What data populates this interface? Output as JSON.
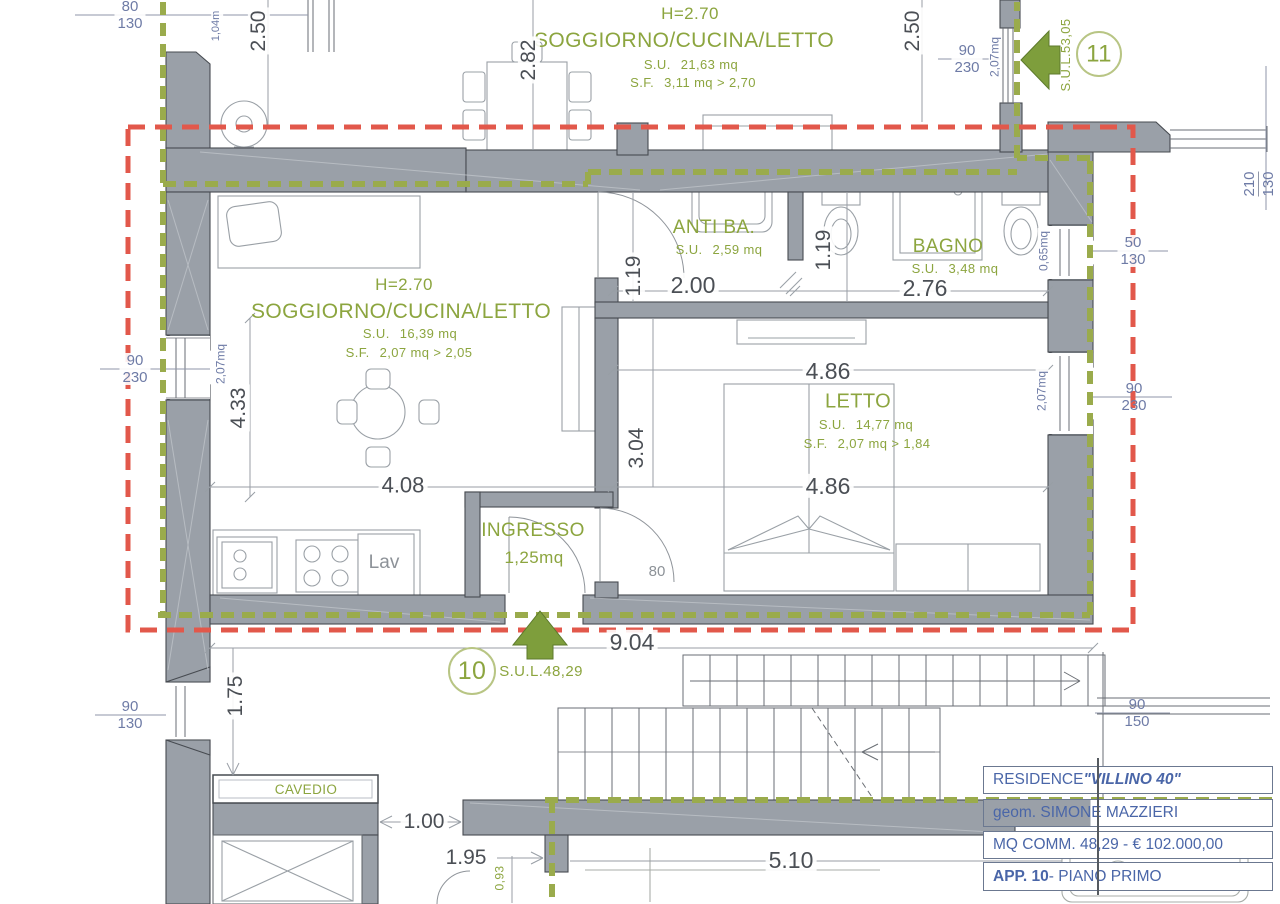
{
  "units": {
    "u10": {
      "number": "10",
      "sul": "S.U.L.48,29"
    },
    "u11": {
      "number": "11",
      "sul": "S.U.L.53,05"
    }
  },
  "rooms": {
    "upper": {
      "height": "H=2.70",
      "name": "SOGGIORNO/CUCINA/LETTO",
      "su_label": "S.U.",
      "su_value": "21,63 mq",
      "sf_label": "S.F.",
      "sf_value": "3,11 mq > 2,70"
    },
    "soggiorno": {
      "height": "H=2.70",
      "name": "SOGGIORNO/CUCINA/LETTO",
      "su_label": "S.U.",
      "su_value": "16,39 mq",
      "sf_label": "S.F.",
      "sf_value": "2,07 mq > 2,05"
    },
    "antibagno": {
      "name": "ANTI BA.",
      "su_label": "S.U.",
      "su_value": "2,59 mq"
    },
    "bagno": {
      "name": "BAGNO",
      "su_label": "S.U.",
      "su_value": "3,48 mq"
    },
    "letto": {
      "name": "LETTO",
      "su_label": "S.U.",
      "su_value": "14,77 mq",
      "sf_label": "S.F.",
      "sf_value": "2,07 mq > 1,84"
    },
    "ingresso": {
      "name": "INGRESSO",
      "area": "1,25mq"
    },
    "cavedio": {
      "name": "CAVEDIO"
    },
    "lav": {
      "name": "Lav"
    }
  },
  "dims": {
    "d80_130": {
      "top": "80",
      "bottom": "130"
    },
    "d104m": "1,04m",
    "d250_left": "2.50",
    "d282": "2.82",
    "d250_right": "2.50",
    "d90_230_top": {
      "top": "90",
      "bottom": "230"
    },
    "d207mq_top": "2,07mq",
    "d210_130": {
      "top": "210",
      "bottom": "130"
    },
    "d119_left": "1.19",
    "d200": "2.00",
    "d119_right": "1.19",
    "d276": "2.76",
    "d065mq": "0,65mq",
    "d50_130": {
      "top": "50",
      "bottom": "130"
    },
    "d90_230_left": {
      "top": "90",
      "bottom": "230"
    },
    "d207mq_left": "2,07mq",
    "d433": "4.33",
    "d90_230_right": {
      "top": "90",
      "bottom": "230"
    },
    "d207mq_right": "2,07mq",
    "d486_top": "4.86",
    "d486_bottom": "4.86",
    "d304": "3.04",
    "d408": "4.08",
    "d80_door": "80",
    "d904": "9.04",
    "d175": "1.75",
    "d90_130": {
      "top": "90",
      "bottom": "130"
    },
    "d90_150": {
      "top": "90",
      "bottom": "150"
    },
    "d100": "1.00",
    "d195": "1.95",
    "d093": "0,93",
    "d510": "5.10"
  },
  "title_block": {
    "row1_normal": "RESIDENCE ",
    "row1_bold": "\"VILLINO 40\"",
    "row2": "geom. SIMONE MAZZIERI",
    "row3": "MQ COMM. 48,29 - € 102.000,00",
    "row4_bold": "APP. 10",
    "row4_normal": " - PIANO PRIMO"
  },
  "colors": {
    "room_green": "#8CA53F",
    "dim_dark": "#4B4F55",
    "dim_blue": "#6E7BA6",
    "red_dash": "#E2584B",
    "green_dash": "#9AAB4C",
    "arrow_green": "#7E9E3C",
    "wall_gray": "#9AA0A8",
    "title_blue": "#4A66A8"
  }
}
